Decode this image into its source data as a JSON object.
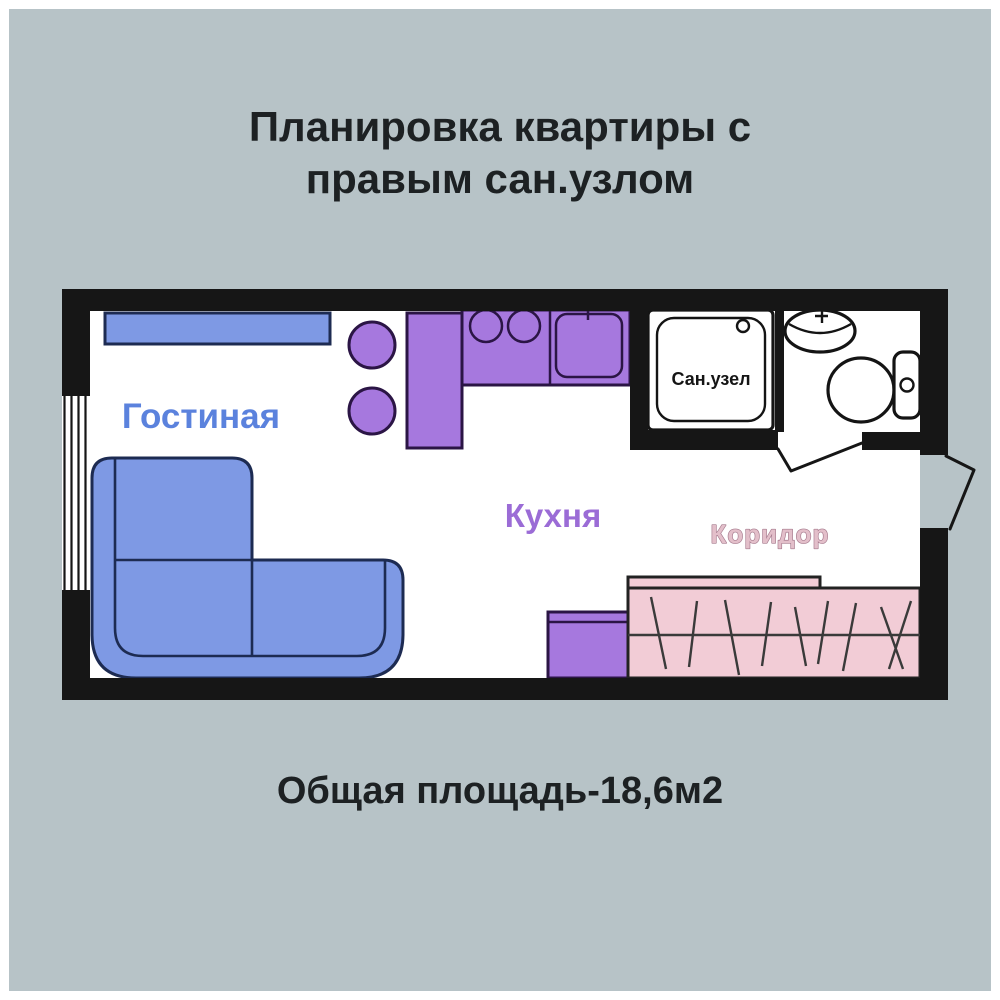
{
  "title": {
    "line1": "Планировка квартиры с",
    "line2": "правым сан.узлом"
  },
  "footer": {
    "area_text": "Общая площадь-18,6м2"
  },
  "plan": {
    "rooms": {
      "living": {
        "label": "Гостиная"
      },
      "kitchen": {
        "label": "Кухня"
      },
      "corridor": {
        "label": "Коридор"
      },
      "bathroom": {
        "label": "Сан.узел"
      }
    }
  },
  "palette": {
    "bg": "#b7c3c7",
    "frame": "#ffffff",
    "wall": "#161616",
    "floor": "#ffffff",
    "furniture-blue": "#7e99e4",
    "furniture-blue-stroke": "#1d2b52",
    "furniture-purple": "#a678de",
    "furniture-purple-stroke": "#2b1545",
    "wardrobe-pink": "#f2ccd6",
    "wardrobe-stroke": "#222222",
    "fixture-stroke": "#141414",
    "label-blue": "#5b82dd",
    "label-purple": "#9b6cd6",
    "label-pink": "#e3bfca",
    "label-pink-stroke": "#a5798c",
    "text-dark": "#1d2123"
  }
}
